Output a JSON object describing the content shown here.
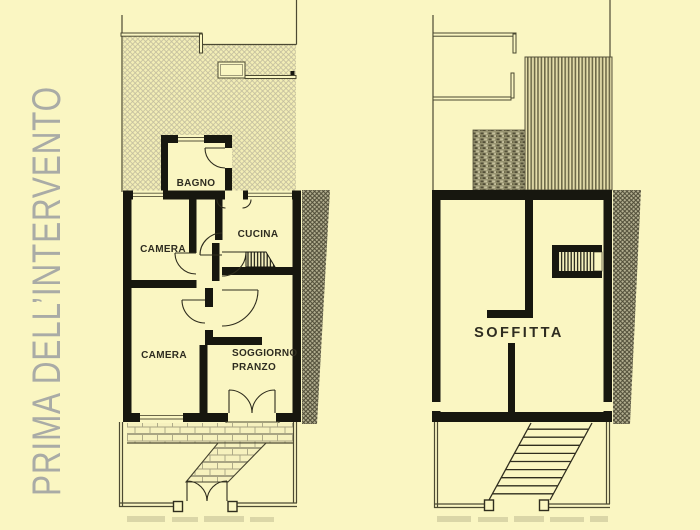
{
  "title": "PRIMA DELL’INTERVENTO",
  "colors": {
    "background": "#FAF6C2",
    "title_text": "#A9ABA6",
    "wall": "#17170F",
    "label_text": "#2E2C20",
    "hatch_line": "#C2BD9E",
    "party_hatch_line": "#4E4B36",
    "roof_stripe": "#6E6A49",
    "paving_line": "#A8A483"
  },
  "plans": {
    "left": {
      "rooms": {
        "bagno": "BAGNO",
        "camera_nord": "CAMERA",
        "cucina": "CUCINA",
        "camera_sud": "CAMERA",
        "soggiorno_line1": "SOGGIORNO",
        "soggiorno_line2": "PRANZO"
      }
    },
    "right": {
      "rooms": {
        "soffitta": "SOFFITTA"
      }
    }
  }
}
